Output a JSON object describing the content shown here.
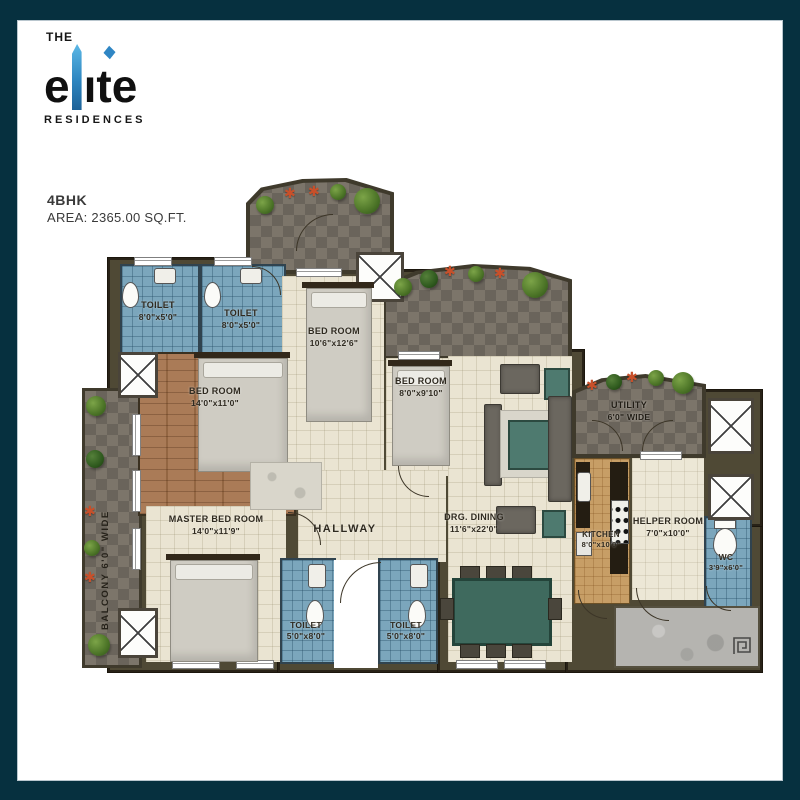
{
  "logo": {
    "the": "THE",
    "elite_prefix": "e",
    "elite_suffix": "ıte",
    "residences": "RESIDENCES",
    "tower_blue": "#4aa7dc",
    "accent_blue": "#2f86c4"
  },
  "unit": {
    "type": "4BHK",
    "area": "AREA: 2365.00 SQ.FT."
  },
  "rooms": {
    "toilet_top_left": {
      "label": "TOILET",
      "dims": "8'0\"x5'0\""
    },
    "toilet_top_right": {
      "label": "TOILET",
      "dims": "8'0\"x5'0\""
    },
    "bedroom_top": {
      "label": "BED ROOM",
      "dims": "10'6\"x12'6\""
    },
    "bedroom_left": {
      "label": "BED ROOM",
      "dims": "14'0\"x11'0\""
    },
    "bedroom_small": {
      "label": "BED ROOM",
      "dims": "8'0\"x9'10\""
    },
    "master_bedroom": {
      "label": "MASTER BED ROOM",
      "dims": "14'0\"x11'9\""
    },
    "hallway": {
      "label": "HALLWAY"
    },
    "drg_dining": {
      "label": "DRG. DINING",
      "dims": "11'6\"x22'0\""
    },
    "kitchen": {
      "label": "KITCHEN",
      "dims": "8'0\"x10'0\""
    },
    "helper_room": {
      "label": "HELPER ROOM",
      "dims": "7'0\"x10'0\""
    },
    "wc": {
      "label": "WC",
      "dims": "3'9\"x6'0\""
    },
    "utility": {
      "label": "UTILITY",
      "dims": "6'0\" WIDE"
    },
    "balcony": {
      "label": "BALCONY  6'0\" WIDE"
    },
    "toilet_bottom_left": {
      "label": "TOILET",
      "dims": "5'0\"x8'0\""
    },
    "toilet_bottom_right": {
      "label": "TOILET",
      "dims": "5'0\"x8'0\""
    }
  },
  "icons": {
    "plant": "bush",
    "flower": "✱",
    "shaft": "x-box",
    "spiral_mark": "square-spiral"
  },
  "colors": {
    "frame": "#06303f",
    "floor_beige": "#eae4d2",
    "toilet_blue": "#7ba6bc",
    "wood_brown": "#a4714a",
    "terrace_gray": "#7c756a",
    "kitchen_tan": "#c79e66",
    "wall_olive": "#4f4935",
    "concrete_gray": "#b5b4b0",
    "dining_teal": "#3f6a5e",
    "plant_green": "#4c7427",
    "flower_red": "#c8502a"
  }
}
